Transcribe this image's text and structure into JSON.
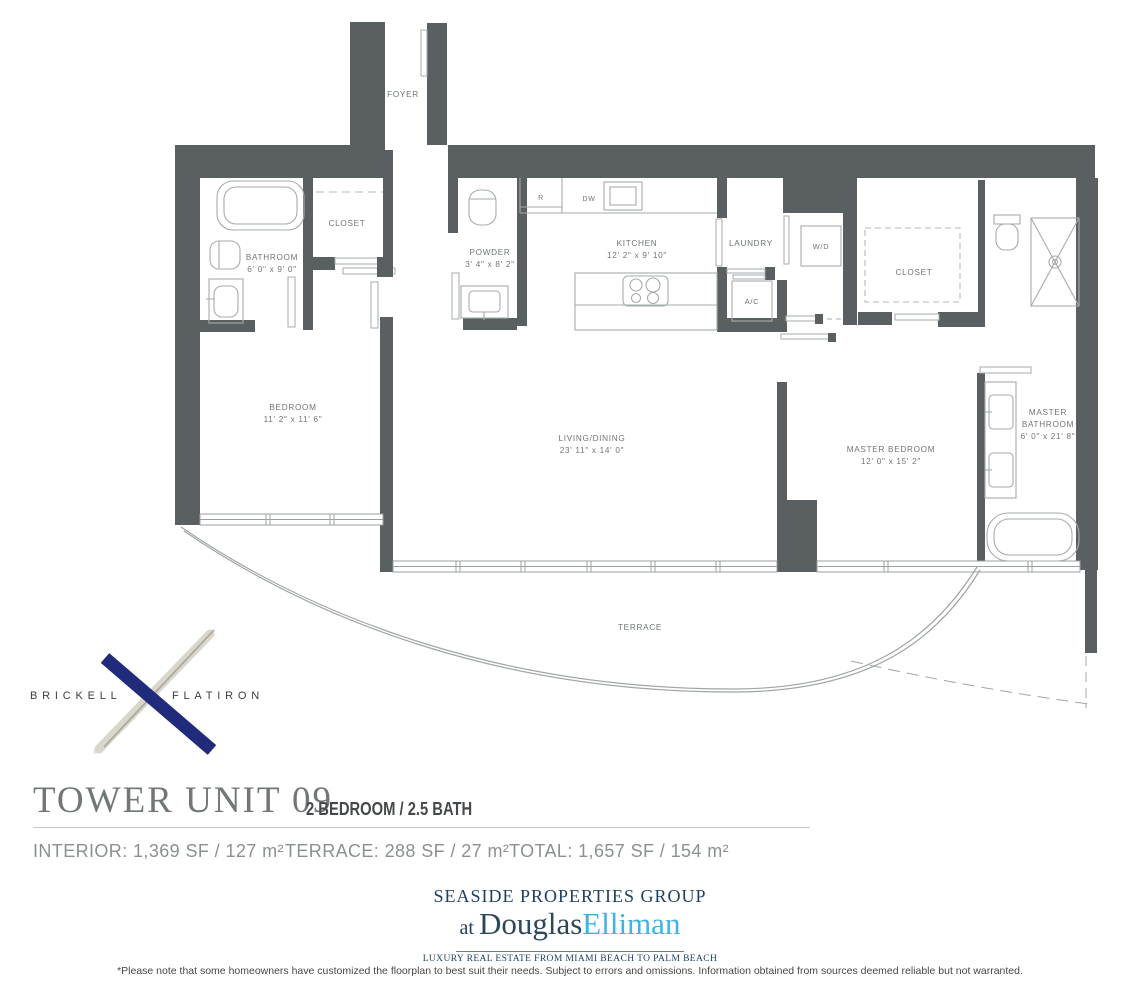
{
  "plan": {
    "wall_color": "#5a6062",
    "rooms": [
      {
        "name": "foyer",
        "label": "FOYER",
        "dims": ""
      },
      {
        "name": "bathroom",
        "label": "BATHROOM",
        "dims": "6' 0\" x 9' 0\""
      },
      {
        "name": "closet",
        "label": "CLOSET",
        "dims": ""
      },
      {
        "name": "powder",
        "label": "POWDER",
        "dims": "3' 4\" x 8' 2\""
      },
      {
        "name": "kitchen",
        "label": "KITCHEN",
        "dims": "12' 2\" x 9' 10\""
      },
      {
        "name": "laundry",
        "label": "LAUNDRY",
        "dims": ""
      },
      {
        "name": "master-closet",
        "label": "CLOSET",
        "dims": ""
      },
      {
        "name": "bedroom",
        "label": "BEDROOM",
        "dims": "11' 2\" x 11' 6\""
      },
      {
        "name": "living-dining",
        "label": "LIVING/DINING",
        "dims": "23' 11\" x 14' 0\""
      },
      {
        "name": "master-bedroom",
        "label": "MASTER BEDROOM",
        "dims": "12' 0\" x 15' 2\""
      },
      {
        "name": "master-bathroom",
        "label_line1": "MASTER",
        "label_line2": "BATHROOM",
        "dims": "6' 0\" x 21' 8\""
      },
      {
        "name": "terrace",
        "label": "TERRACE",
        "dims": ""
      }
    ],
    "appliances": {
      "refrigerator": "R",
      "dishwasher": "DW",
      "washer_dryer": "W/D",
      "air_conditioning": "A/C"
    }
  },
  "branding": {
    "left": "BRICKELL",
    "right": "FLATIRON",
    "x_navy": "#202b7c",
    "feather": "#d9d6cc"
  },
  "title": {
    "main": "TOWER UNIT 09",
    "subtitle": "2 BEDROOM / 2.5 BATH"
  },
  "stats": {
    "interior": "INTERIOR: 1,369 SF / 127 m²",
    "terrace": "TERRACE:  288 SF / 27 m²",
    "total": "TOTAL: 1,657 SF / 154 m²"
  },
  "broker": {
    "group": "SEASIDE PROPERTIES GROUP",
    "at": "at ",
    "brand_first": "Douglas",
    "brand_second": "Elliman",
    "tagline": "LUXURY REAL ESTATE FROM MIAMI BEACH TO PALM BEACH",
    "brand_blue": "#3fb3e4",
    "brand_navy": "#1e3f62"
  },
  "disclaimer": "*Please note that some homeowners have customized the floorplan to best suit their needs. Subject to errors and omissions. Information obtained from sources deemed reliable but not warranted."
}
